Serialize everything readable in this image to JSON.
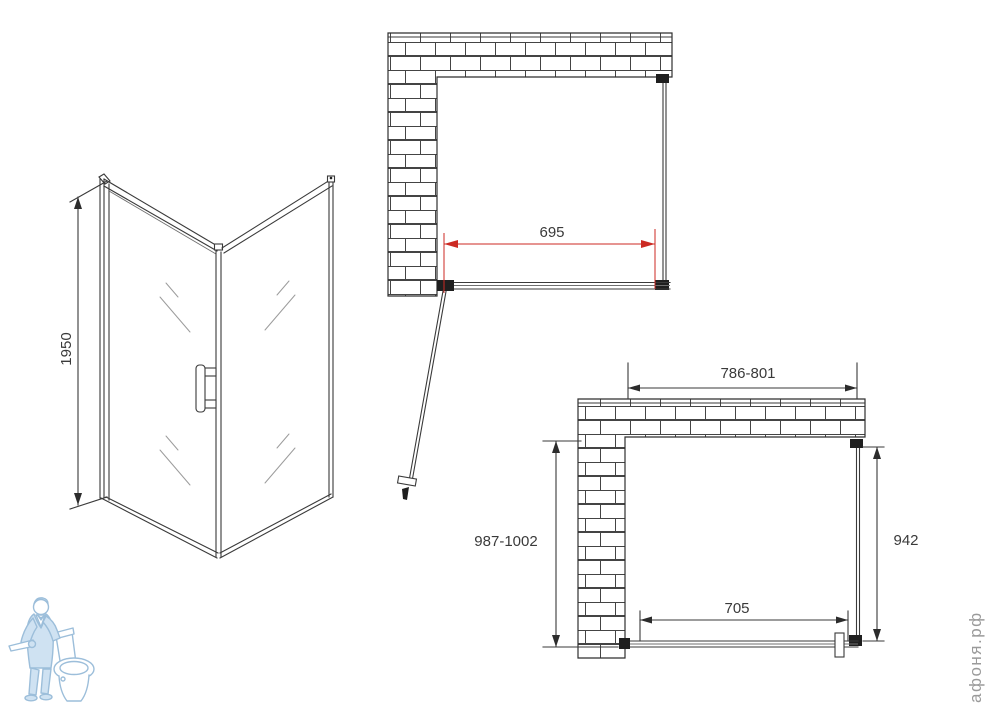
{
  "colors": {
    "line": "#3a3a3a",
    "accent_red": "#cc2a23",
    "brick_line": "#444444",
    "logo_blue": "#9cbeda",
    "logo_fill": "#cfe2f2",
    "watermark_gray": "#9a9a9a"
  },
  "isometric_view": {
    "height_dimension": "1950"
  },
  "front_view": {
    "opening_width_dimension": "695"
  },
  "plan_view": {
    "overall_width_dimension": "786-801",
    "overall_depth_dimension": "987-1002",
    "side_panel_dimension": "942",
    "door_width_dimension": "705"
  },
  "watermark": {
    "text": "афоня.рф"
  }
}
